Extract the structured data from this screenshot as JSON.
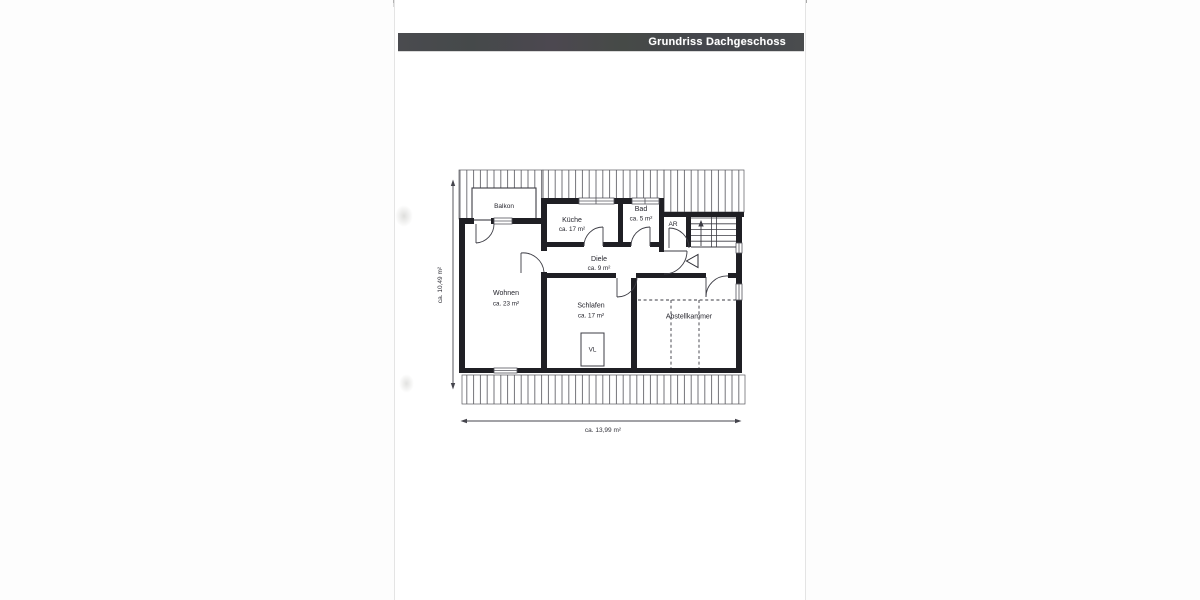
{
  "header": {
    "title": "Grundriss Dachgeschoss"
  },
  "floorplan": {
    "rooms": {
      "balkon": {
        "label": "Balkon"
      },
      "kueche": {
        "label": "Küche",
        "area": "ca. 17 m²"
      },
      "bad": {
        "label": "Bad",
        "area": "ca. 5 m²"
      },
      "ar": {
        "label": "AR"
      },
      "diele": {
        "label": "Diele",
        "area": "ca. 9 m²"
      },
      "wohnen": {
        "label": "Wohnen",
        "area": "ca. 23 m²"
      },
      "schlafen": {
        "label": "Schlafen",
        "area": "ca. 17 m²"
      },
      "abstellkammer": {
        "label": "Abstellkammer"
      },
      "vl": {
        "label": "VL"
      }
    },
    "dimensions": {
      "width_label": "ca. 13,99 m²",
      "height_label": "ca. 10,49 m²"
    },
    "colors": {
      "wall": "#1f1f24",
      "line": "#3c3c44",
      "header_bar": "#47484d"
    }
  }
}
